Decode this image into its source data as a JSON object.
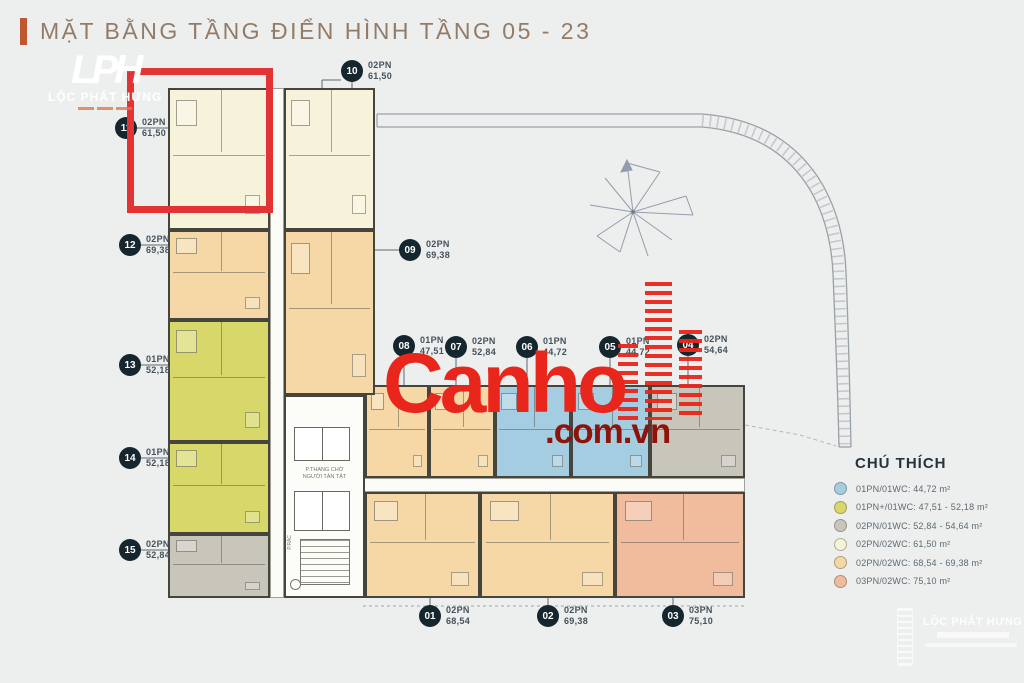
{
  "title": {
    "text": "MẶT BẰNG TẦNG ĐIỂN HÌNH TẦNG 05 - 23"
  },
  "brand_top_left": {
    "monogram": "LPH",
    "name": "LỘC PHÁT HƯNG"
  },
  "brand_bottom_right": {
    "name": "LỘC PHÁT HƯNG"
  },
  "watermark": {
    "main": "Canho",
    "suffix": ".com.vn",
    "color_main": "#e8261b",
    "color_suffix": "#8c140b"
  },
  "highlight": {
    "unit": "11",
    "color": "#e23434"
  },
  "palette": {
    "blue": "#a5cde2",
    "yellow": "#d7d869",
    "gray": "#c8c5bb",
    "cream": "#f7f3da",
    "peach": "#f6d8a7",
    "salmon": "#f1bb9d"
  },
  "units": [
    {
      "number": "01",
      "type": "02PN",
      "area": "68,54",
      "color": "peach"
    },
    {
      "number": "02",
      "type": "02PN",
      "area": "69,38",
      "color": "peach"
    },
    {
      "number": "03",
      "type": "03PN",
      "area": "75,10",
      "color": "salmon"
    },
    {
      "number": "04",
      "type": "02PN",
      "area": "54,64",
      "color": "gray"
    },
    {
      "number": "05",
      "type": "01PN",
      "area": "44,72",
      "color": "blue"
    },
    {
      "number": "06",
      "type": "01PN",
      "area": "44,72",
      "color": "blue"
    },
    {
      "number": "07",
      "type": "02PN",
      "area": "52,84",
      "color": "peach"
    },
    {
      "number": "08",
      "type": "01PN",
      "area": "47,51",
      "color": "peach"
    },
    {
      "number": "09",
      "type": "02PN",
      "area": "69,38",
      "color": "peach"
    },
    {
      "number": "10",
      "type": "02PN",
      "area": "61,50",
      "color": "cream"
    },
    {
      "number": "11",
      "type": "02PN",
      "area": "61,50",
      "color": "cream"
    },
    {
      "number": "12",
      "type": "02PN",
      "area": "69,38",
      "color": "peach"
    },
    {
      "number": "13",
      "type": "01PN",
      "area": "52,18",
      "color": "yellow"
    },
    {
      "number": "14",
      "type": "01PN",
      "area": "52,18",
      "color": "yellow"
    },
    {
      "number": "15",
      "type": "02PN",
      "area": "52,84",
      "color": "gray"
    }
  ],
  "core": {
    "line1": "P.THANG CHỜ",
    "line2": "NGƯỜI TÀN TẬT",
    "trash": "P.RÁC"
  },
  "legend": {
    "title": "CHÚ THÍCH",
    "items": [
      {
        "label": "01PN/01WC: 44,72 m²",
        "color": "#a5cde2"
      },
      {
        "label": "01PN+/01WC: 47,51 - 52,18 m²",
        "color": "#d7d869"
      },
      {
        "label": "02PN/01WC: 52,84 - 54,64 m²",
        "color": "#c8c5bb"
      },
      {
        "label": "02PN/02WC: 61,50 m²",
        "color": "#f7f3da"
      },
      {
        "label": "02PN/02WC: 68,54 - 69,38 m²",
        "color": "#f6d8a7"
      },
      {
        "label": "03PN/02WC: 75,10 m²",
        "color": "#f1bb9d"
      }
    ]
  }
}
